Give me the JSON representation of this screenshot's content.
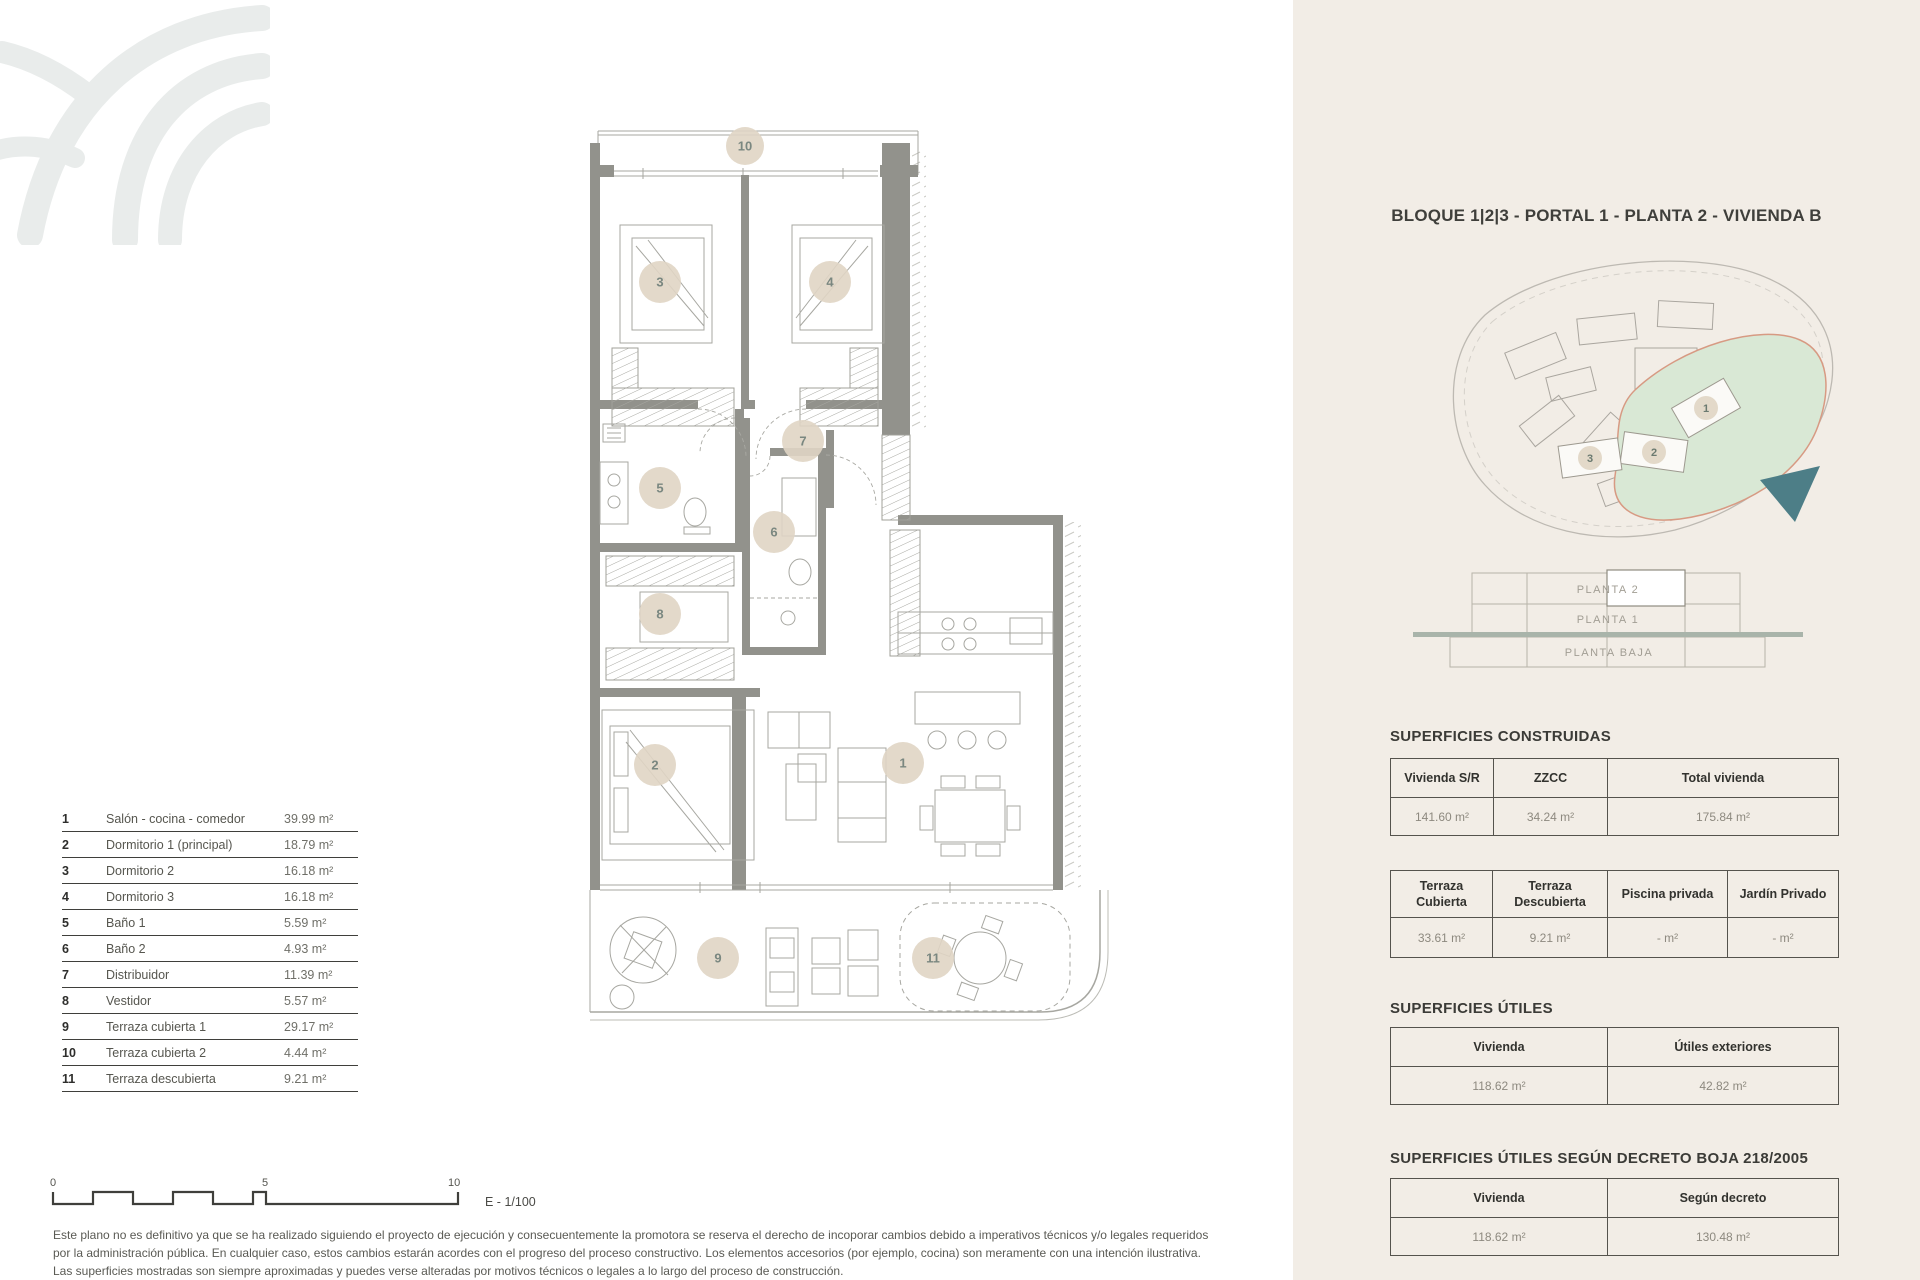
{
  "legend": {
    "rows": [
      {
        "num": "1",
        "name": "Salón - cocina - comedor",
        "area": "39.99 m²"
      },
      {
        "num": "2",
        "name": "Dormitorio 1 (principal)",
        "area": "18.79 m²"
      },
      {
        "num": "3",
        "name": "Dormitorio 2",
        "area": "16.18 m²"
      },
      {
        "num": "4",
        "name": "Dormitorio 3",
        "area": "16.18 m²"
      },
      {
        "num": "5",
        "name": "Baño 1",
        "area": "5.59 m²"
      },
      {
        "num": "6",
        "name": "Baño 2",
        "area": "4.93 m²"
      },
      {
        "num": "7",
        "name": "Distribuidor",
        "area": "11.39 m²"
      },
      {
        "num": "8",
        "name": "Vestidor",
        "area": "5.57 m²"
      },
      {
        "num": "9",
        "name": "Terraza cubierta 1",
        "area": "29.17 m²"
      },
      {
        "num": "10",
        "name": "Terraza cubierta 2",
        "area": "4.44 m²"
      },
      {
        "num": "11",
        "name": "Terraza descubierta",
        "area": "9.21 m²"
      }
    ]
  },
  "plan": {
    "rooms": [
      "1",
      "2",
      "3",
      "4",
      "5",
      "6",
      "7",
      "8",
      "9",
      "10",
      "11"
    ]
  },
  "scale_bar": {
    "t0": "0",
    "t5": "5",
    "t10": "10",
    "label": "E - 1/100"
  },
  "disclaimer": {
    "line1": "Este plano no es definitivo ya que se ha realizado siguiendo el proyecto de ejecución y consecuentemente la promotora se reserva el derecho de incoporar cambios debido a imperativos técnicos y/o legales requeridos",
    "line2": "por la administración pública. En cualquier caso, estos cambios estarán acordes con el progreso del proceso constructivo. Los elementos accesorios (por ejemplo, cocina) son meramente con una intención ilustrativa.",
    "line3": "Las superficies mostradas son siempre aproximadas y puedes verse alteradas por motivos técnicos o legales a lo largo del proceso de construcción."
  },
  "panel": {
    "title": "BLOQUE 1|2|3 - PORTAL 1 - PLANTA 2 - VIVIENDA B",
    "map": {
      "b1": "1",
      "b2": "2",
      "b3": "3"
    },
    "floors": {
      "p2": "PLANTA 2",
      "p1": "PLANTA 1",
      "pb": "PLANTA BAJA"
    },
    "construidas": {
      "heading": "SUPERFICIES CONSTRUIDAS",
      "t1_headers": [
        "Vivienda S/R",
        "ZZCC",
        "Total vivienda"
      ],
      "t1_values": [
        "141.60 m²",
        "34.24 m²",
        "175.84 m²"
      ],
      "t2_headers": [
        "Terraza Cubierta",
        "Terraza Descubierta",
        "Piscina privada",
        "Jardín Privado"
      ],
      "t2_values": [
        "33.61 m²",
        "9.21 m²",
        "- m²",
        "- m²"
      ]
    },
    "utiles": {
      "heading": "SUPERFICIES ÚTILES",
      "headers": [
        "Vivienda",
        "Útiles exteriores"
      ],
      "values": [
        "118.62 m²",
        "42.82 m²"
      ]
    },
    "decreto": {
      "heading": "SUPERFICIES ÚTILES SEGÚN DECRETO BOJA 218/2005",
      "headers": [
        "Vivienda",
        "Según decreto"
      ],
      "values": [
        "118.62 m²",
        "130.48 m²"
      ]
    }
  },
  "colors": {
    "panel_bg": "#f2ede6",
    "wall": "#92928c",
    "room_badge": "#e0d5c4",
    "badge_text": "#7a8780",
    "green_area": "#d9e8d5",
    "green_border": "#d79a83",
    "arrow": "#4d7e87",
    "ground_line": "#a9b4aa"
  }
}
